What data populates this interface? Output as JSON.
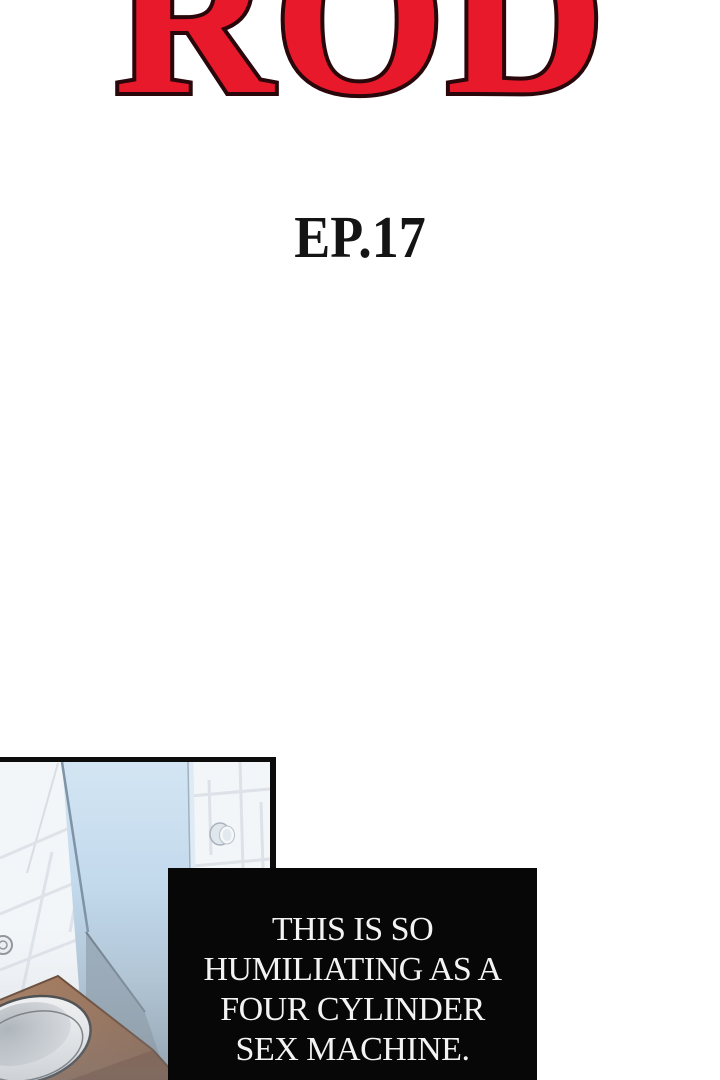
{
  "title": {
    "text": "ROD",
    "color": "#e8192b",
    "outline_color": "#2a070a"
  },
  "episode": {
    "label": "EP.17",
    "color": "#141414"
  },
  "panel": {
    "scene": "bathroom with shower glass, tiled walls, wooden counter and sink",
    "border_color": "#0c0c0c"
  },
  "dialog": {
    "background": "#070707",
    "text_color": "#f3f3f3",
    "lines": {
      "0": "THIS IS SO",
      "1": "HUMILIATING AS A",
      "2": "FOUR CYLINDER",
      "3": "SEX MACHINE."
    }
  }
}
